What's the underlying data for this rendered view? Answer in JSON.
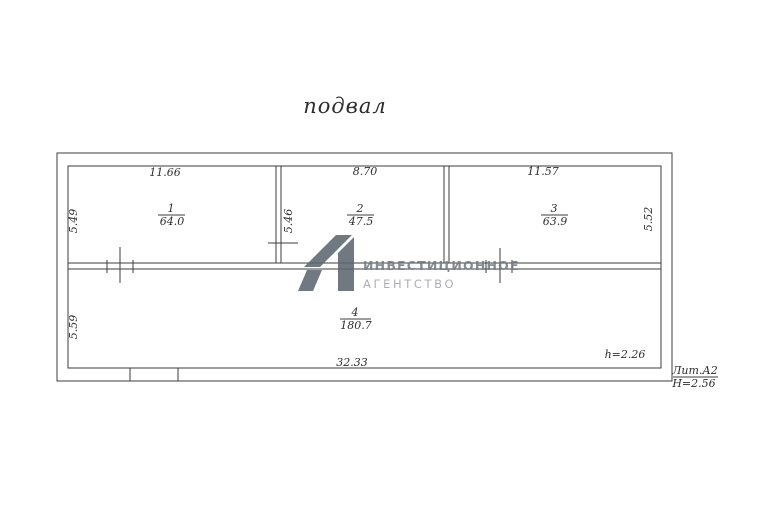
{
  "page": {
    "title": "подвал"
  },
  "plan": {
    "rooms": [
      {
        "number": "1",
        "area": "64.0"
      },
      {
        "number": "2",
        "area": "47.5"
      },
      {
        "number": "3",
        "area": "63.9"
      },
      {
        "number": "4",
        "area": "180.7"
      }
    ],
    "dimensions": {
      "room1_top": "11.66",
      "room2_top": "8.70",
      "room3_top": "11.57",
      "room1_left": "5.49",
      "room4_left": "5.59",
      "wall12": "5.46",
      "room3_right": "5.52",
      "bottom": "32.33"
    },
    "notes": {
      "inner_height": "h=2.26",
      "liter": "Лит.А2",
      "outer_height": "Н=2.56"
    }
  },
  "watermark": {
    "logo": "А1",
    "line1": "ИНВЕСТИЦИОННОЕ",
    "line2": "АГЕНТСТВО"
  },
  "colors": {
    "line": "#3c3c3c",
    "watermark_logo": "#5d6771",
    "watermark_text_primary": "#767d85",
    "watermark_text_secondary": "#a0a5ab"
  }
}
